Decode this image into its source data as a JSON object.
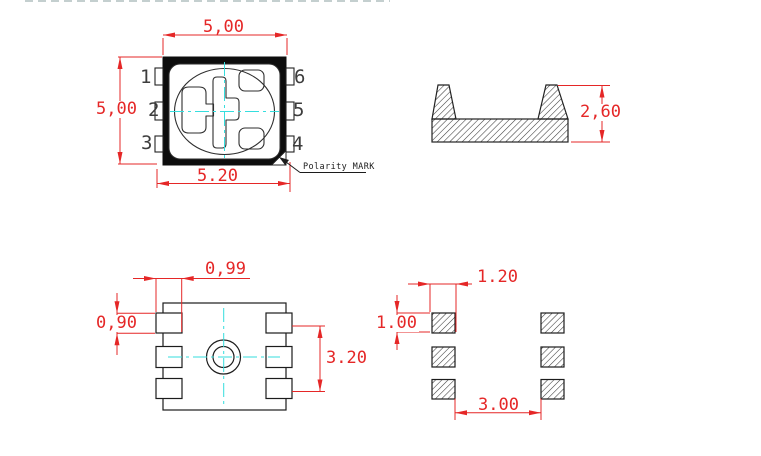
{
  "drawing_title": "SMD LED package outline drawing",
  "colors": {
    "dimension_red": "#e52727",
    "line_black": "#222222",
    "centerline_cyan": "#35dede",
    "body_fill": "#0d0d0d"
  },
  "top_view": {
    "dim_top_width": "5,00",
    "dim_left_height": "5,00",
    "dim_bottom_width": "5.20",
    "pins": {
      "pin1": "1",
      "pin2": "2",
      "pin3": "3",
      "pin4": "4",
      "pin5": "5",
      "pin6": "6"
    },
    "polarity_label": "Polarity MARK"
  },
  "side_view": {
    "dim_height": "2,60"
  },
  "bottom_view": {
    "dim_pad_width": "0,99",
    "dim_pad_height": "0,90",
    "dim_pad_pitch": "3.20"
  },
  "land_pattern": {
    "dim_pad_width": "1.20",
    "dim_pad_height": "1.00",
    "dim_gap": "3.00"
  }
}
